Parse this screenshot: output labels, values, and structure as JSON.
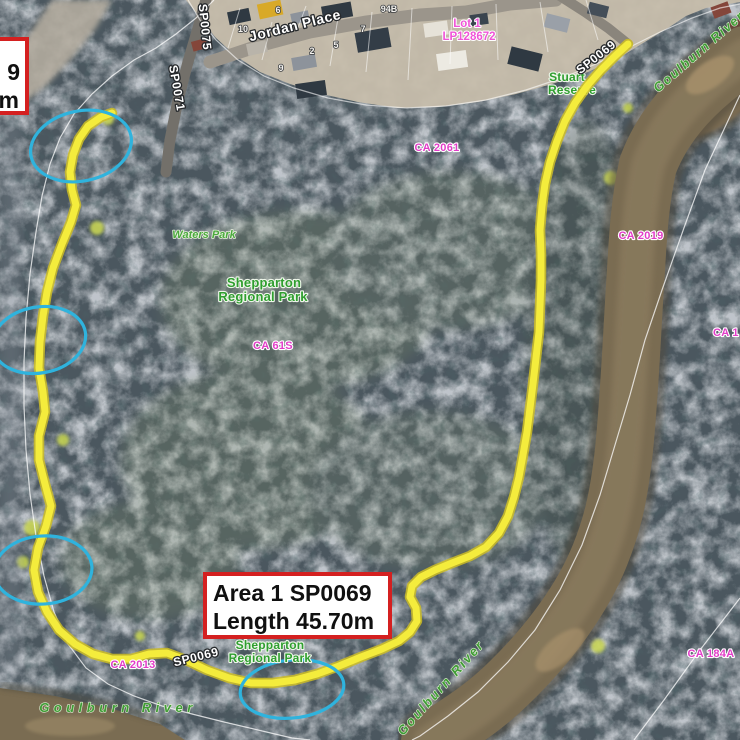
{
  "annotation": {
    "partial_box": {
      "line1": "9",
      "line2": "m"
    },
    "main_box": {
      "line1": "Area 1 SP0069",
      "line2": "Length 45.70m"
    }
  },
  "parcel_labels": {
    "ca2061": "CA 2061",
    "ca2019": "CA 2019",
    "ca1": "CA 1",
    "ca61s": "CA 61S",
    "ca2013": "CA 2013",
    "ca184a": "CA 184A"
  },
  "lot_labels": {
    "lot1": "Lot 1",
    "plan": "LP128672"
  },
  "street_labels": {
    "sp0075": "SP0075",
    "sp0071": "SP0071",
    "jordan_place": "Jordan Place",
    "sp0069_top": "SP0069",
    "sp0069_bottom": "SP0069"
  },
  "house_numbers": {
    "n10": "10",
    "n6": "6",
    "n2": "2",
    "n5": "5",
    "n9": "9",
    "n7": "7",
    "n94b": "94B"
  },
  "park_labels": {
    "waters_park": "Waters Park",
    "regional_park_line1": "Shepparton",
    "regional_park_line2": "Regional Park",
    "reserve_line1": "Stuart",
    "reserve_line2": "Reserve"
  },
  "river_labels": {
    "goulburn_top_right": "Goulburn River",
    "goulburn_bottom_left": "Goulburn River",
    "goulburn_bottom_center": "Goulburn River"
  },
  "colors": {
    "track_yellow": "#f4ec3c",
    "highlight_circle_blue": "#2fb3dd",
    "parcel_label_magenta": "#e23cc8",
    "park_label_green": "#2f9e2f",
    "river_label_green": "#3f9c35",
    "annotation_border_red": "#d42020"
  }
}
